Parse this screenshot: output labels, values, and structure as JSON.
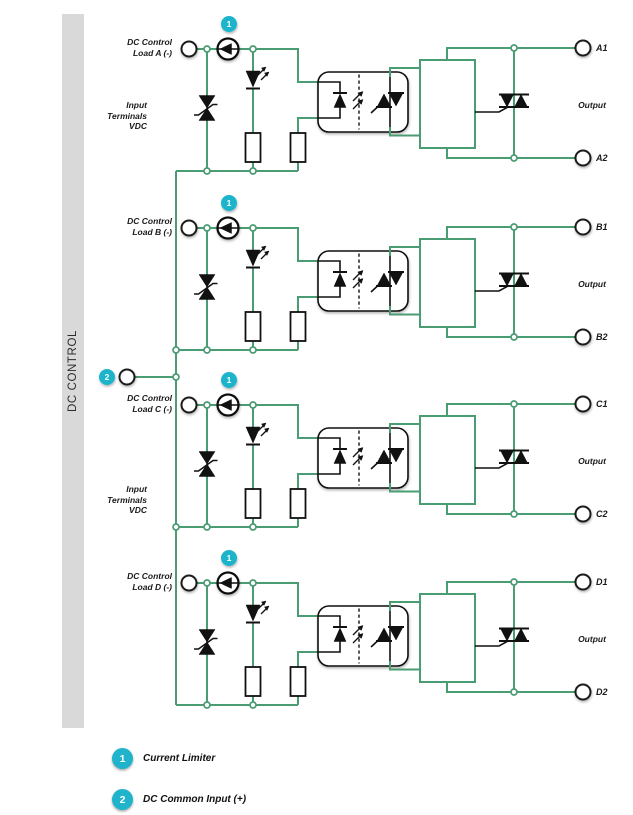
{
  "sidebar": {
    "title": "DC CONTROL"
  },
  "colors": {
    "wire": "#4a9c72",
    "badge": "#1fb4cb",
    "bar_bg": "#d9d9d9",
    "component": "#111111"
  },
  "channels": [
    {
      "id": "A",
      "load_label": [
        "DC Control",
        "Load A (-)"
      ],
      "input_note": [
        "Input",
        "Terminals",
        "VDC"
      ],
      "limiter_badge": "1",
      "output_label": "Output",
      "terminal_top": "A1",
      "terminal_bottom": "A2"
    },
    {
      "id": "B",
      "load_label": [
        "DC Control",
        "Load B (-)"
      ],
      "input_note": null,
      "limiter_badge": "1",
      "output_label": "Output",
      "terminal_top": "B1",
      "terminal_bottom": "B2"
    },
    {
      "id": "C",
      "load_label": [
        "DC Control",
        "Load C (-)"
      ],
      "input_note": [
        "Input",
        "Terminals",
        "VDC"
      ],
      "limiter_badge": "1",
      "output_label": "Output",
      "terminal_top": "C1",
      "terminal_bottom": "C2"
    },
    {
      "id": "D",
      "load_label": [
        "DC Control",
        "Load D (-)"
      ],
      "input_note": null,
      "limiter_badge": "1",
      "output_label": "Output",
      "terminal_top": "D1",
      "terminal_bottom": "D2"
    }
  ],
  "common_input": {
    "badge": "2"
  },
  "legend": [
    {
      "badge": "1",
      "label": "Current Limiter"
    },
    {
      "badge": "2",
      "label": "DC Common Input (+)"
    }
  ]
}
